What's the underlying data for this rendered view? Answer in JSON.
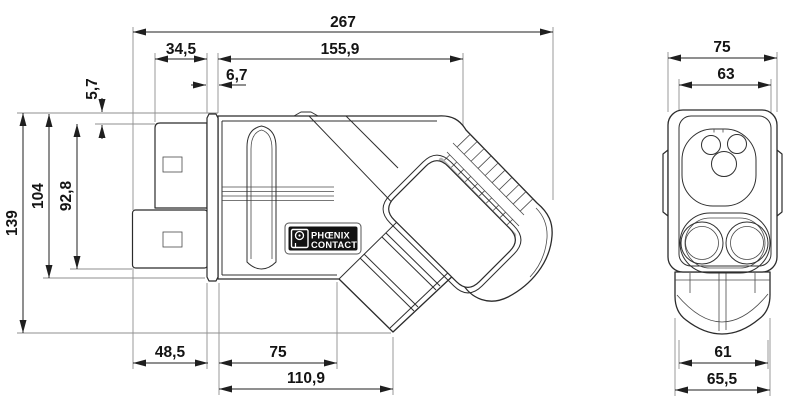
{
  "dims": {
    "side": {
      "total": "267",
      "grip": "155,9",
      "tip": "34,5",
      "flange": "6,7",
      "step": "5,7",
      "body_height": "104",
      "tip_height": "92,8",
      "total_height": "139",
      "tip_bottom": "48,5",
      "body_bottom": "75",
      "cable_bottom": "110,9"
    },
    "front": {
      "total": "75",
      "face": "63",
      "bottom": "61",
      "housing": "65,5"
    }
  },
  "logo": {
    "line1": "PHŒNIX",
    "line2": "CONTACT"
  }
}
